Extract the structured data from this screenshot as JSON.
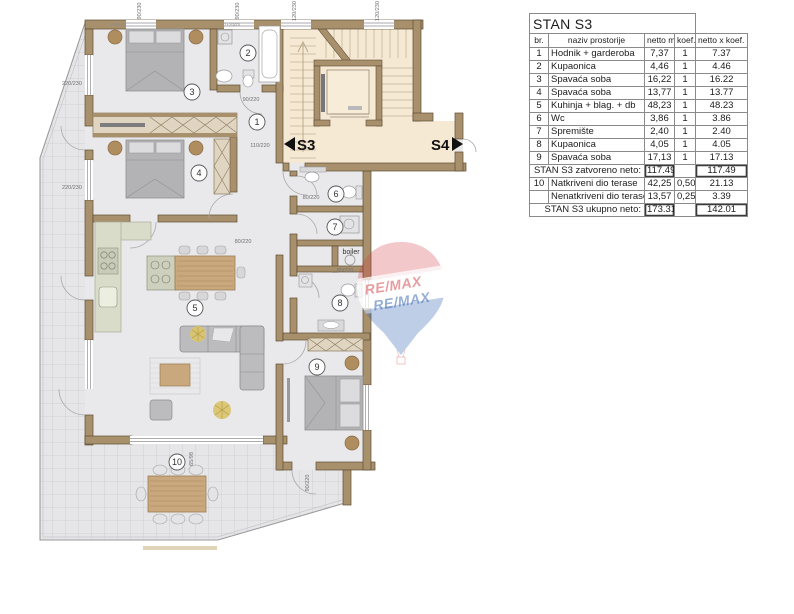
{
  "table": {
    "title": "STAN S3",
    "headers": [
      "br.",
      "naziv prostorije",
      "netto m²",
      "koef.",
      "netto x koef. m²"
    ],
    "rows": [
      {
        "br": "1",
        "name": "Hodnik + garderoba",
        "netto": "7,37",
        "koef": "1",
        "total": "7.37"
      },
      {
        "br": "2",
        "name": "Kupaonica",
        "netto": "4,46",
        "koef": "1",
        "total": "4.46"
      },
      {
        "br": "3",
        "name": "Spavaća soba",
        "netto": "16,22",
        "koef": "1",
        "total": "16.22"
      },
      {
        "br": "4",
        "name": "Spavaća soba",
        "netto": "13,77",
        "koef": "1",
        "total": "13.77"
      },
      {
        "br": "5",
        "name": "Kuhinja + blag. + db",
        "netto": "48,23",
        "koef": "1",
        "total": "48.23"
      },
      {
        "br": "6",
        "name": "Wc",
        "netto": "3,86",
        "koef": "1",
        "total": "3.86"
      },
      {
        "br": "7",
        "name": "Spremište",
        "netto": "2,40",
        "koef": "1",
        "total": "2.40"
      },
      {
        "br": "8",
        "name": "Kupaonica",
        "netto": "4,05",
        "koef": "1",
        "total": "4.05"
      },
      {
        "br": "9",
        "name": "Spavaća soba",
        "netto": "17,13",
        "koef": "1",
        "total": "17.13"
      },
      {
        "br": "",
        "name": "STAN S3 zatvoreno neto:",
        "netto": "117.49",
        "koef": "",
        "total": "117.49",
        "summary": true
      },
      {
        "br": "10",
        "name": "Natkriveni dio terase",
        "netto": "42,25",
        "koef": "0,50",
        "total": "21.13"
      },
      {
        "br": "",
        "name": "Nenatkriveni dio terase",
        "netto": "13,57",
        "koef": "0,25",
        "total": "3.39"
      },
      {
        "br": "",
        "name": "STAN S3 ukupno neto:",
        "netto": "173.31",
        "koef": "",
        "total": "142.01",
        "summary": true
      }
    ]
  },
  "plan": {
    "unit_label": "S3",
    "adjacent_unit_label": "S4",
    "boiler_label": "bojler",
    "rooms": [
      {
        "n": "1",
        "x": 257,
        "y": 122
      },
      {
        "n": "2",
        "x": 248,
        "y": 53
      },
      {
        "n": "3",
        "x": 192,
        "y": 92
      },
      {
        "n": "4",
        "x": 199,
        "y": 173
      },
      {
        "n": "5",
        "x": 195,
        "y": 308
      },
      {
        "n": "6",
        "x": 336,
        "y": 194
      },
      {
        "n": "7",
        "x": 335,
        "y": 227
      },
      {
        "n": "8",
        "x": 340,
        "y": 303
      },
      {
        "n": "9",
        "x": 317,
        "y": 367
      },
      {
        "n": "10",
        "x": 177,
        "y": 462
      }
    ],
    "dimensions": [
      {
        "t": "90/230",
        "x": 141,
        "y": 11,
        "r": -90
      },
      {
        "t": "90/230",
        "x": 239,
        "y": 11,
        "r": -90
      },
      {
        "t": "120/230",
        "x": 296,
        "y": 11,
        "r": -90
      },
      {
        "t": "120/230",
        "x": 379,
        "y": 11,
        "r": -90
      },
      {
        "t": "220/230",
        "x": 72,
        "y": 85,
        "r": 0
      },
      {
        "t": "220/230",
        "x": 72,
        "y": 189,
        "r": 0
      },
      {
        "t": "90/220",
        "x": 251,
        "y": 101,
        "r": 0
      },
      {
        "t": "110/220",
        "x": 260,
        "y": 147,
        "r": 0
      },
      {
        "t": "80/220",
        "x": 311,
        "y": 199,
        "r": 0
      },
      {
        "t": "80/220",
        "x": 243,
        "y": 243,
        "r": 0
      },
      {
        "t": "80/220",
        "x": 345,
        "y": 272,
        "r": 0
      },
      {
        "t": "90/220",
        "x": 309,
        "y": 483,
        "r": -90
      },
      {
        "t": "65/98",
        "x": 193,
        "y": 459,
        "r": -90
      }
    ],
    "lintel_notes": [
      {
        "t": "7+20cm",
        "x": 117,
        "y": 26
      },
      {
        "t": "7+20cm",
        "x": 232,
        "y": 26
      }
    ],
    "watermark": {
      "line1": "RE/MAX",
      "line2": "RE/MAX"
    },
    "colors": {
      "wall": "#a8906c",
      "stair_floor": "#f6e9d4",
      "room_floor": "#e9e9eb",
      "terrace_tile": "#e6e6e8",
      "watermark_red": "#cf3a40",
      "watermark_blue": "#2b5eae"
    }
  }
}
